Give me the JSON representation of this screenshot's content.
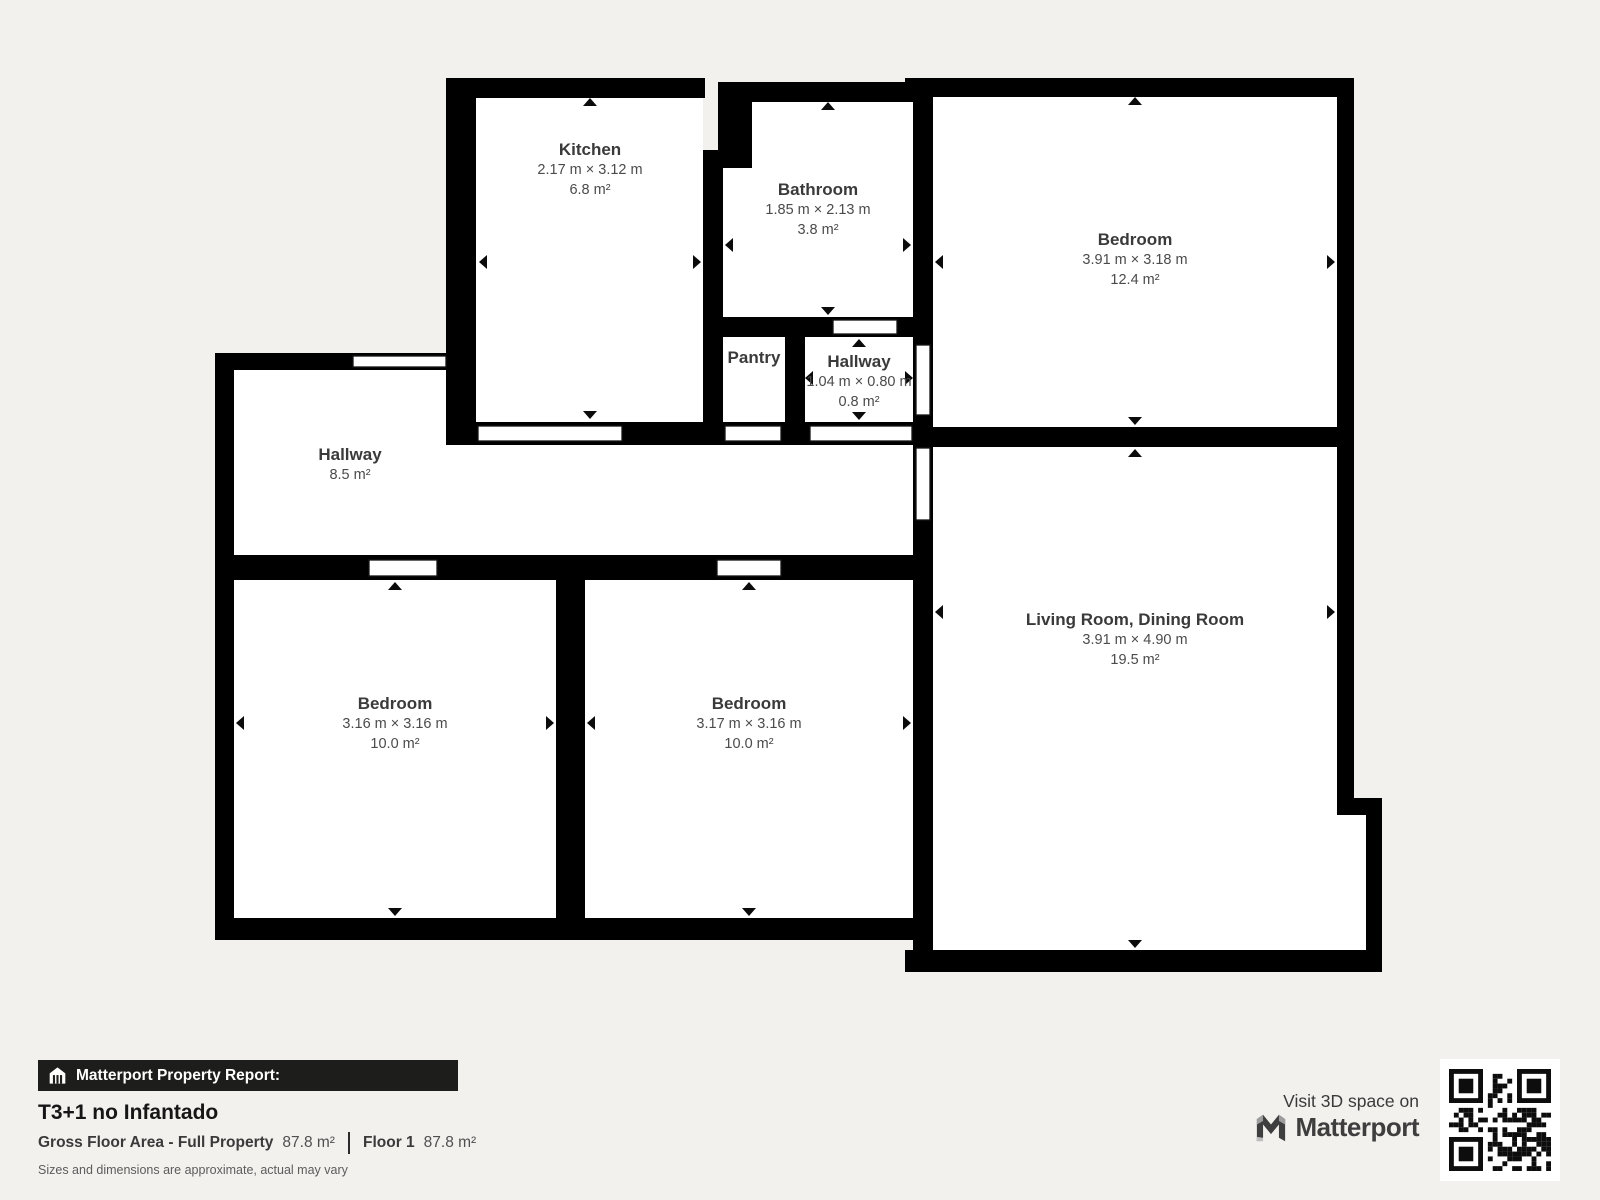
{
  "colors": {
    "background": "#f2f1ee",
    "wall": "#000000",
    "room_fill": "#ffffff",
    "banner_bg": "#1d1d1b",
    "text_dark": "#3a3a3a"
  },
  "rooms": [
    {
      "id": "kitchen",
      "name": "Kitchen",
      "dimensions": "2.17 m × 3.12 m",
      "area": "6.8 m²"
    },
    {
      "id": "bathroom",
      "name": "Bathroom",
      "dimensions": "1.85 m × 2.13 m",
      "area": "3.8 m²"
    },
    {
      "id": "bedroom-top-right",
      "name": "Bedroom",
      "dimensions": "3.91 m × 3.18 m",
      "area": "12.4 m²"
    },
    {
      "id": "pantry",
      "name": "Pantry"
    },
    {
      "id": "hallway-small",
      "name": "Hallway",
      "dimensions": "1.04 m × 0.80 m",
      "area": "0.8 m²"
    },
    {
      "id": "hallway",
      "name": "Hallway",
      "area": "8.5 m²"
    },
    {
      "id": "bedroom-left",
      "name": "Bedroom",
      "dimensions": "3.16 m × 3.16 m",
      "area": "10.0 m²"
    },
    {
      "id": "bedroom-middle",
      "name": "Bedroom",
      "dimensions": "3.17 m × 3.16 m",
      "area": "10.0 m²"
    },
    {
      "id": "living-room",
      "name": "Living Room, Dining Room",
      "dimensions": "3.91 m × 4.90 m",
      "area": "19.5 m²"
    }
  ],
  "report": {
    "banner": "Matterport Property Report:",
    "title": "T3+1 no Infantado",
    "gross_label": "Gross Floor Area - Full Property",
    "gross_value": "87.8 m²",
    "floor_label": "Floor 1",
    "floor_value": "87.8 m²",
    "disclaimer": "Sizes and dimensions are approximate, actual may vary"
  },
  "promo": {
    "visit_text": "Visit 3D space on",
    "brand": "Matterport"
  }
}
